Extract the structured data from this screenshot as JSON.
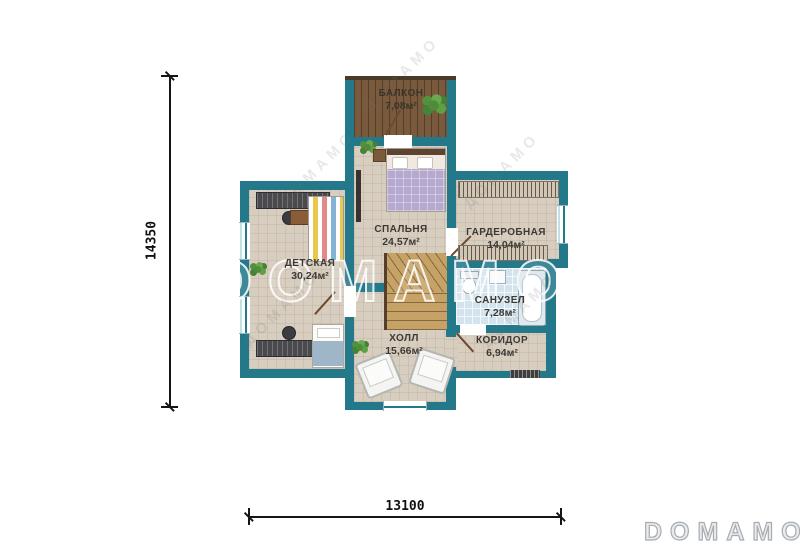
{
  "rooms": [
    {
      "name": "БАЛКОН",
      "area": "7,08м²"
    },
    {
      "name": "СПАЛЬНЯ",
      "area": "24,57м²"
    },
    {
      "name": "ГАРДЕРОБНАЯ",
      "area": "14,04м²"
    },
    {
      "name": "ДЕТСКАЯ",
      "area": "30,24м²"
    },
    {
      "name": "САНУЗЕЛ",
      "area": "7,28м²"
    },
    {
      "name": "ХОЛЛ",
      "area": "15,66м²"
    },
    {
      "name": "КОРИДОР",
      "area": "6,94м²"
    }
  ],
  "dimensions": {
    "vertical": "14350",
    "horizontal": "13100"
  },
  "watermark": {
    "large": "DOMAMO",
    "diagonal": "ДОМАМО"
  },
  "logo": {
    "text": "DOMAMO"
  },
  "colors": {
    "wall": "#23798a",
    "floor_beige": "#d8cec0",
    "balcony_wood": "#7a5a3d",
    "stairs_wood": "#c7a266",
    "bath_tile": "#d3e4ee",
    "accent_dark": "#151515"
  }
}
